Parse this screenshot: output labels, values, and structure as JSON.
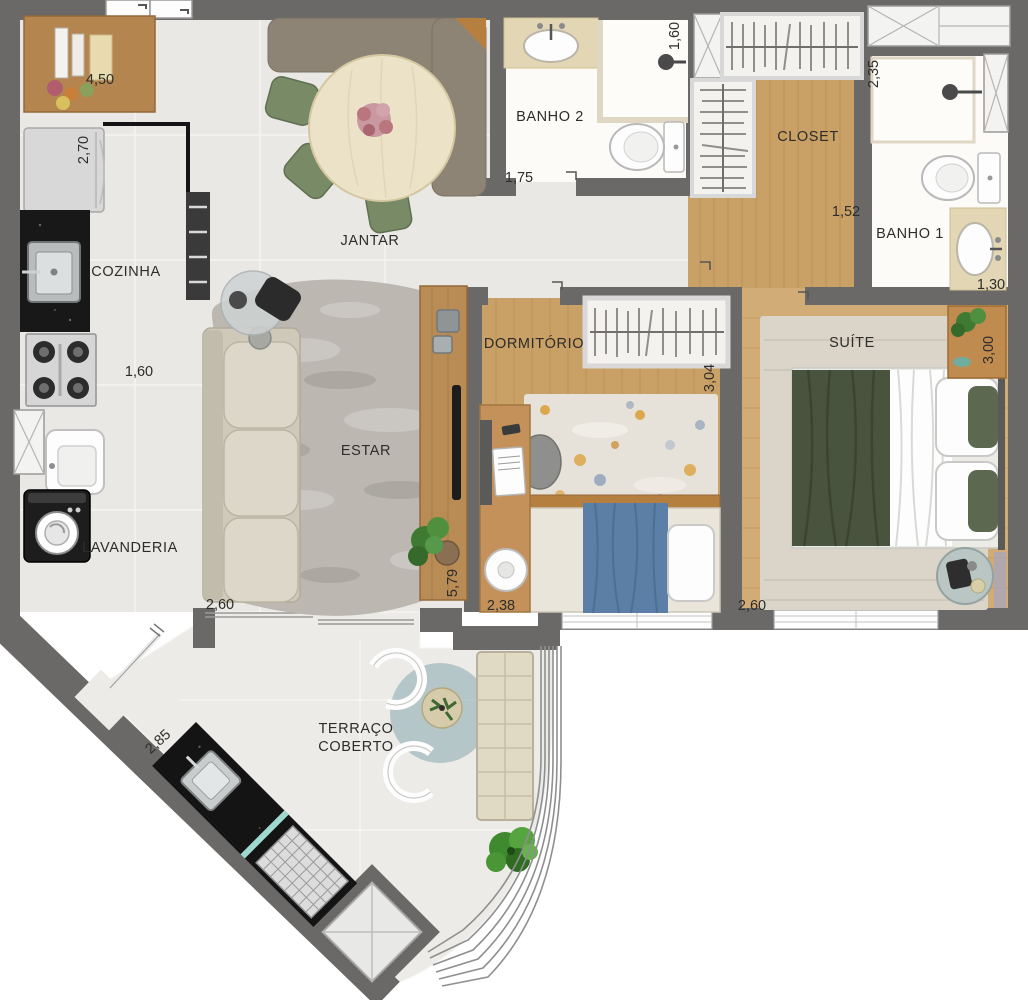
{
  "rooms": {
    "cozinha": {
      "label": "COZINHA"
    },
    "jantar": {
      "label": "JANTAR"
    },
    "banho2": {
      "label": "BANHO 2"
    },
    "closet": {
      "label": "CLOSET"
    },
    "banho1": {
      "label": "BANHO 1"
    },
    "estar": {
      "label": "ESTAR"
    },
    "lavanderia": {
      "label": "LAVANDERIA"
    },
    "dormitorio": {
      "label": "DORMITÓRIO"
    },
    "suite": {
      "label": "SUÍTE"
    },
    "terraco": {
      "label_line1": "TERRAÇO",
      "label_line2": "COBERTO"
    }
  },
  "dimensions": {
    "kitchen_counter": "4,50",
    "fridge_side": "2,70",
    "kitchen_width": "1,60",
    "estar_width": "2,60",
    "estar_length": "5,79",
    "terrace_diagonal": "2,85",
    "hall_width": "1,75",
    "banho2_depth": "1,60",
    "banho1_depth": "2,35",
    "closet_width": "1,52",
    "banho1_width": "1,30",
    "dorm_length": "3,04",
    "dorm_width": "2,38",
    "suite_width": "2,60",
    "suite_length": "3,00"
  },
  "colors": {
    "wall": "#6a6968",
    "tile_floor": "#eae8e4",
    "wood_floor": "#c9a065",
    "suite_wood_floor": "#d2ac76",
    "bath_floor": "#fcfbf8",
    "counter_beige": "#e3d6b4",
    "bench_brown": "#8d8475",
    "chair_green": "#798b66",
    "bed_blue": "#5b7fa6",
    "bed_green": "#49543f",
    "terrace_rug_teal": "#9db7ba",
    "black_counter": "#181818"
  }
}
